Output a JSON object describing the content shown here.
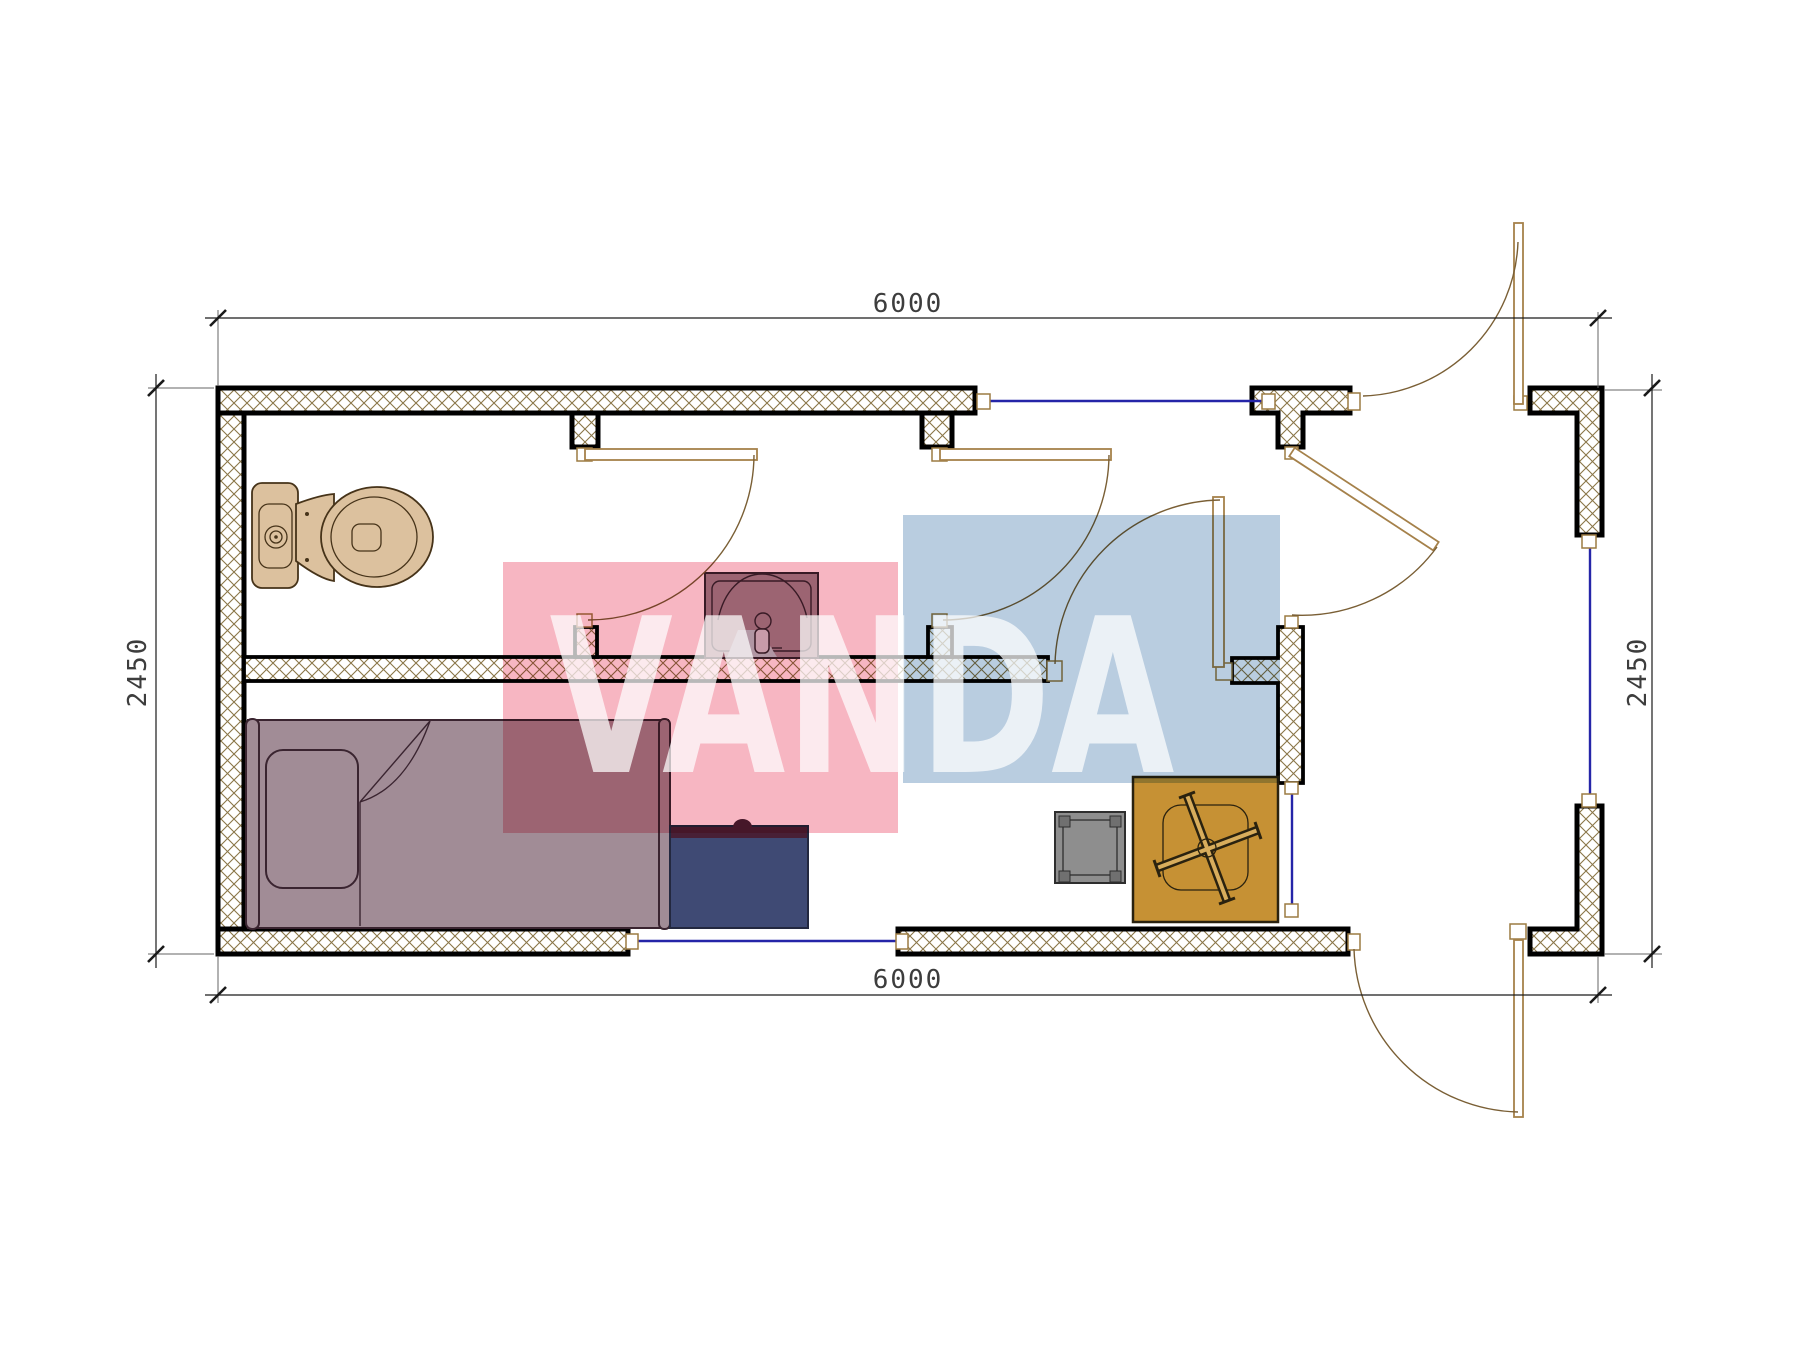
{
  "document": {
    "type": "architectural-floor-plan",
    "description": "container cabin plan with WC, washroom, bedroom and entrance hall"
  },
  "dimensions": {
    "top": "6000",
    "bottom": "6000",
    "left": "2450",
    "right": "2450"
  },
  "watermark": {
    "text": "VANDA"
  },
  "colors": {
    "wall_stroke": "#000000",
    "hatch_line": "#8a7648",
    "window_blue": "#2525a8",
    "door_leaf": "#a5814a",
    "door_arc": "#7a5f35",
    "door_frame": "#9c7b42",
    "dim_line": "#1a1a1a",
    "dim_text": "#3d3d3d",
    "toilet_fill": "#dcc19e",
    "toilet_stroke": "#463319",
    "mauve_fill": "#a18c96",
    "mauve_stroke": "#3a2430",
    "desk_fill": "#3f4a74",
    "desk_band": "#482036",
    "desk_stroke": "#23283f",
    "stool_fill": "#8e8e8e",
    "stool_feet": "#707070",
    "stool_stroke": "#2e2e2e",
    "table_fill": "#c69134",
    "table_stroke": "#2a220f",
    "table_inner": "#d8ad5c",
    "faucet_fill": "#cfd9df",
    "water_fill": "#b7d2d6",
    "wm_pink": "#f7b6c2",
    "wm_blue": "#b9cde0",
    "wm_text": "#ffffff"
  },
  "fixtures": [
    "toilet",
    "wash-basin",
    "single-bed",
    "desk",
    "stool",
    "square-table-cross-legs"
  ],
  "openings": [
    "wc-door",
    "washroom-door",
    "bedroom-door",
    "hall-door",
    "entrance-door-top",
    "exit-door-bottom",
    "window-top",
    "window-right",
    "window-bottom",
    "glazed-partition"
  ]
}
